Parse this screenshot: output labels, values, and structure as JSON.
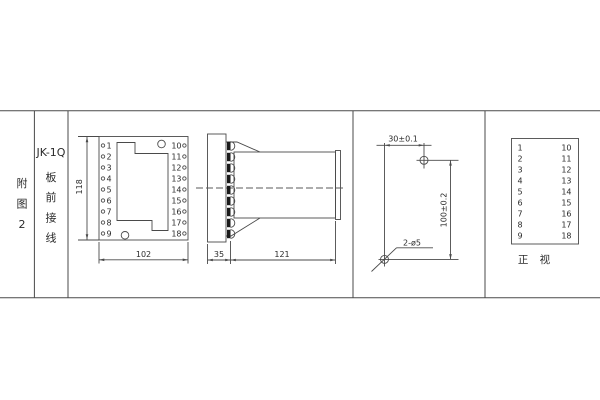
{
  "left_panel": {
    "figure_label": [
      "附",
      "图",
      "2"
    ],
    "model": "JK-1Q",
    "wiring_label": [
      "板",
      "前",
      "接",
      "线"
    ]
  },
  "front_view": {
    "left_terminals": [
      "1",
      "2",
      "3",
      "4",
      "5",
      "6",
      "7",
      "8",
      "9"
    ],
    "right_terminals": [
      "10",
      "11",
      "12",
      "13",
      "14",
      "15",
      "16",
      "17",
      "18"
    ],
    "height_dim": "118",
    "width_dim": "102"
  },
  "side_view": {
    "panel_depth_dim": "35",
    "body_length_dim": "121"
  },
  "drill_view": {
    "horizontal_dim": "30±0.1",
    "vertical_dim": "100±0.2",
    "holes_label": "2-ø5"
  },
  "terminal_table": {
    "left_column": [
      "1",
      "2",
      "3",
      "4",
      "5",
      "6",
      "7",
      "8",
      "9"
    ],
    "right_column": [
      "10",
      "11",
      "12",
      "13",
      "14",
      "15",
      "16",
      "17",
      "18"
    ],
    "caption": "正 视"
  },
  "colors": {
    "line": "#4a4a4a",
    "text": "#2b2b2b",
    "background": "#ffffff"
  }
}
